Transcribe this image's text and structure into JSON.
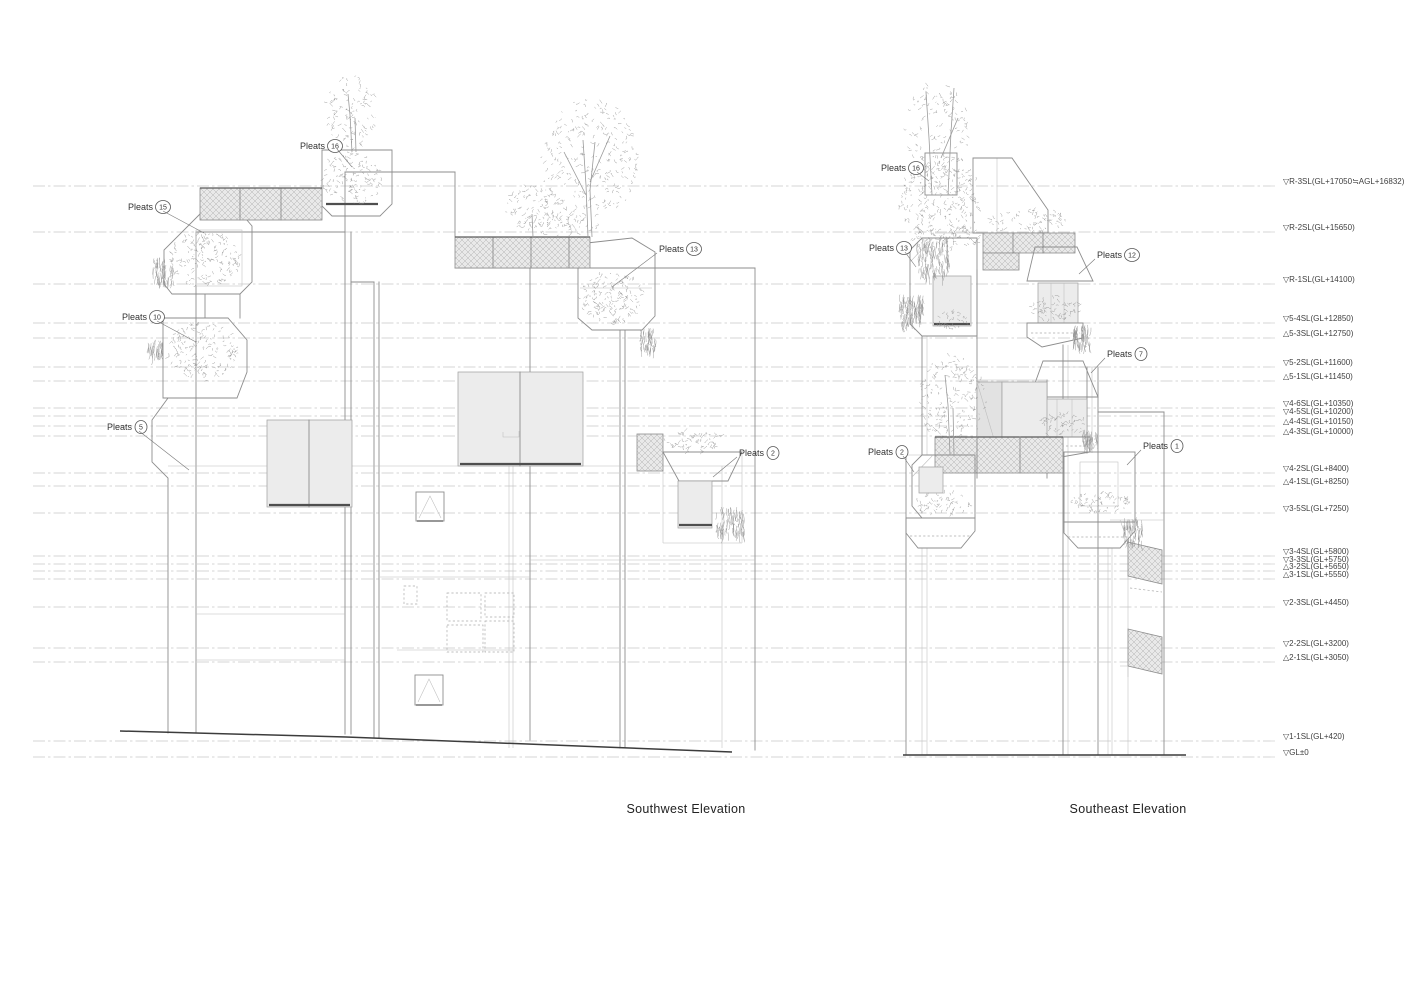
{
  "sheet": {
    "width": 1415,
    "height": 1000,
    "background": "#ffffff"
  },
  "colors": {
    "outline": "#8d8d8d",
    "thin_line": "#bdbdbd",
    "ground": "#3c3c3c",
    "glass_fill": "#ececec",
    "hatch_bg": "#e9e9e9",
    "level_line": "#c9c9c9",
    "text": "#3f3f3f"
  },
  "titles": {
    "southwest": "Southwest Elevation",
    "southeast": "Southeast Elevation"
  },
  "levels": [
    {
      "label": "▽R-3SL(GL+17050≒AGL+16832)",
      "y": 186
    },
    {
      "label": "▽R-2SL(GL+15650)",
      "y": 232
    },
    {
      "label": "▽R-1SL(GL+14100)",
      "y": 284
    },
    {
      "label": "▽5-4SL(GL+12850)",
      "y": 323
    },
    {
      "label": "△5-3SL(GL+12750)",
      "y": 338
    },
    {
      "label": "▽5-2SL(GL+11600)",
      "y": 367
    },
    {
      "label": "△5-1SL(GL+11450)",
      "y": 381
    },
    {
      "label": "▽4-6SL(GL+10350)",
      "y": 408
    },
    {
      "label": "▽4-5SL(GL+10200)",
      "y": 416
    },
    {
      "label": "△4-4SL(GL+10150)",
      "y": 426
    },
    {
      "label": "△4-3SL(GL+10000)",
      "y": 436
    },
    {
      "label": "▽4-2SL(GL+8400)",
      "y": 473
    },
    {
      "label": "△4-1SL(GL+8250)",
      "y": 486
    },
    {
      "label": "▽3-5SL(GL+7250)",
      "y": 513
    },
    {
      "label": "▽3-4SL(GL+5800)",
      "y": 556
    },
    {
      "label": "▽3-3SL(GL+5750)",
      "y": 564
    },
    {
      "label": "△3-2SL(GL+5650)",
      "y": 571
    },
    {
      "label": "△3-1SL(GL+5550)",
      "y": 579
    },
    {
      "label": "▽2-3SL(GL+4450)",
      "y": 607
    },
    {
      "label": "▽2-2SL(GL+3200)",
      "y": 648
    },
    {
      "label": "△2-1SL(GL+3050)",
      "y": 662
    },
    {
      "label": "▽1-1SL(GL+420)",
      "y": 741
    },
    {
      "label": "▽GL±0",
      "y": 757
    }
  ],
  "pleats": {
    "southwest": [
      {
        "label": "Pleats",
        "num": "16",
        "tx": 300,
        "ty": 146,
        "leader": [
          [
            337,
            149
          ],
          [
            352,
            167
          ]
        ]
      },
      {
        "label": "Pleats",
        "num": "15",
        "tx": 128,
        "ty": 207,
        "leader": [
          [
            163,
            211
          ],
          [
            204,
            233
          ]
        ]
      },
      {
        "label": "Pleats",
        "num": "10",
        "tx": 122,
        "ty": 317,
        "leader": [
          [
            157,
            321
          ],
          [
            196,
            342
          ]
        ]
      },
      {
        "label": "Pleats",
        "num": "13",
        "tx": 659,
        "ty": 249,
        "leader": [
          [
            657,
            253
          ],
          [
            612,
            287
          ]
        ]
      },
      {
        "label": "Pleats",
        "num": "5",
        "tx": 107,
        "ty": 427,
        "leader": [
          [
            139,
            431
          ],
          [
            189,
            470
          ]
        ]
      },
      {
        "label": "Pleats",
        "num": "2",
        "tx": 739,
        "ty": 453,
        "leader": [
          [
            737,
            457
          ],
          [
            713,
            477
          ]
        ]
      }
    ],
    "southeast": [
      {
        "label": "Pleats",
        "num": "16",
        "tx": 881,
        "ty": 168,
        "leader": [
          [
            917,
            172
          ],
          [
            929,
            181
          ]
        ]
      },
      {
        "label": "Pleats",
        "num": "13",
        "tx": 869,
        "ty": 248,
        "leader": [
          [
            905,
            252
          ],
          [
            916,
            267
          ]
        ]
      },
      {
        "label": "Pleats",
        "num": "12",
        "tx": 1097,
        "ty": 255,
        "leader": [
          [
            1095,
            259
          ],
          [
            1079,
            274
          ]
        ]
      },
      {
        "label": "Pleats",
        "num": "7",
        "tx": 1107,
        "ty": 354,
        "leader": [
          [
            1105,
            358
          ],
          [
            1091,
            373
          ]
        ]
      },
      {
        "label": "Pleats",
        "num": "2",
        "tx": 868,
        "ty": 452,
        "leader": [
          [
            903,
            456
          ],
          [
            914,
            472
          ]
        ]
      },
      {
        "label": "Pleats",
        "num": "1",
        "tx": 1143,
        "ty": 446,
        "leader": [
          [
            1141,
            450
          ],
          [
            1127,
            465
          ]
        ]
      }
    ]
  }
}
